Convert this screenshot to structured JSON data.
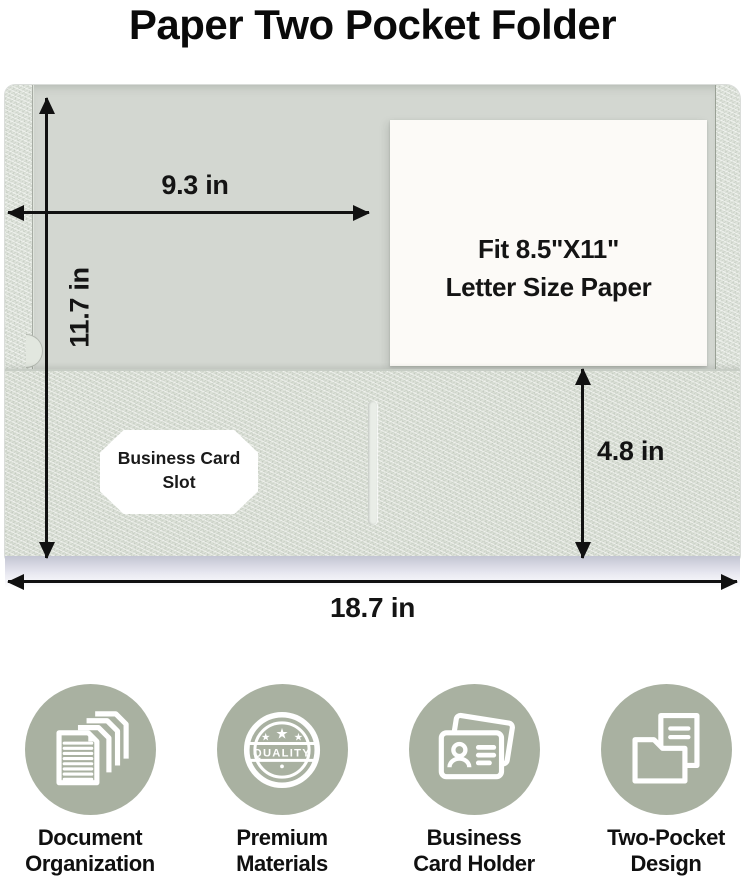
{
  "title": "Paper Two Pocket Folder",
  "folder_diagram": {
    "open_width_label": "9.3 in",
    "height_label": "11.7 in",
    "pocket_depth_label": "4.8 in",
    "total_width_label": "18.7 in",
    "paper_fit_line1": "Fit 8.5\"X11\"",
    "paper_fit_line2": "Letter Size Paper",
    "card_slot_line1": "Business Card",
    "card_slot_line2": "Slot"
  },
  "features": [
    {
      "icon": "stacked-documents-icon",
      "line1": "Document",
      "line2": "Organization"
    },
    {
      "icon": "quality-badge-icon",
      "line1": "Premium",
      "line2": "Materials",
      "badge_text": "QUALITY"
    },
    {
      "icon": "business-card-icon",
      "line1": "Business",
      "line2": "Card Holder"
    },
    {
      "icon": "two-pocket-folder-icon",
      "line1": "Two-Pocket",
      "line2": "Design"
    }
  ],
  "colors": {
    "feature_circle": "#a9b1a1",
    "folder_texture": "#dfe4dc",
    "folder_inner_panel": "#d3d7d1",
    "pocket_texture": "#dce1d8",
    "paper_white": "#fcfaf7",
    "text": "#111111"
  }
}
